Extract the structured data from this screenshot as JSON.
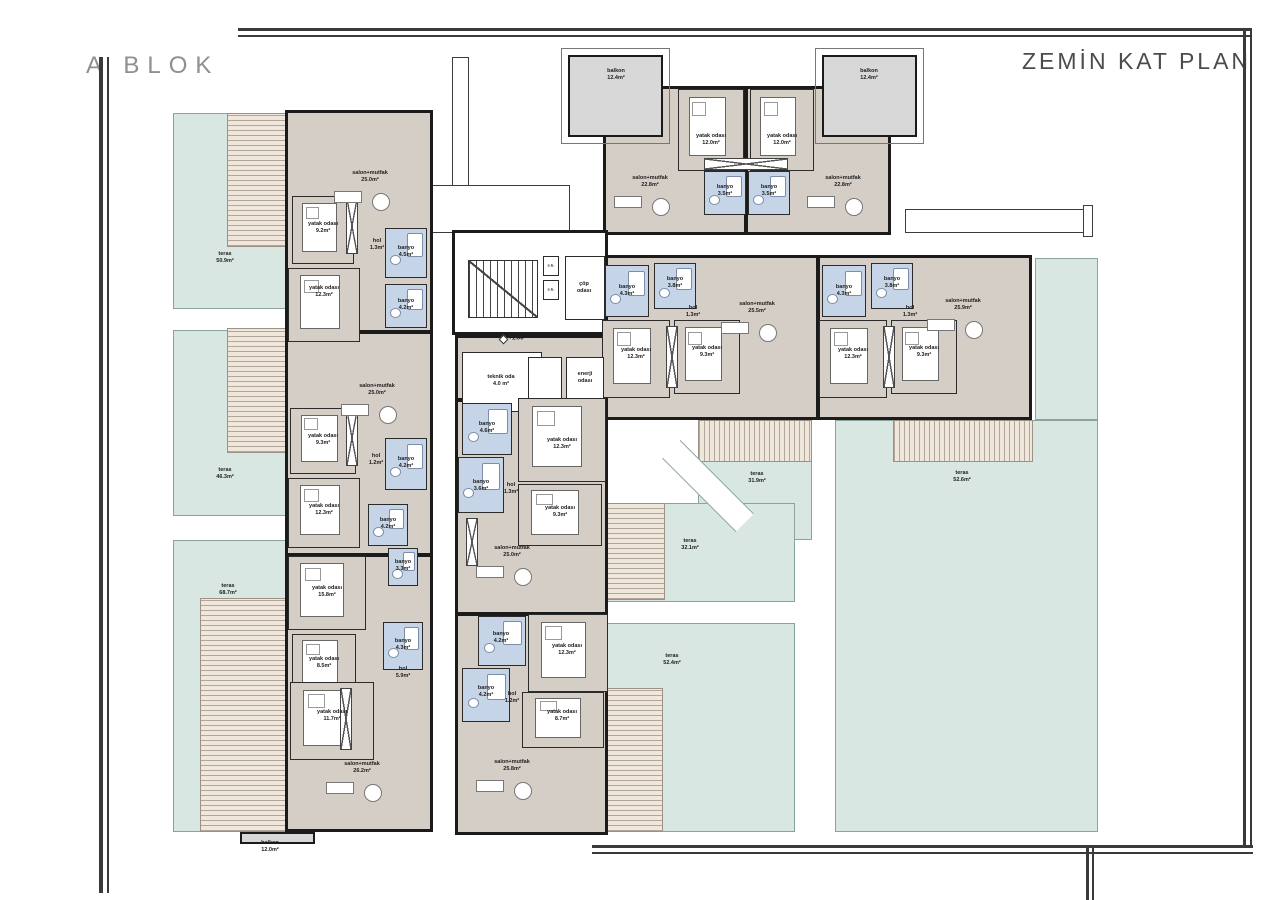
{
  "titles": {
    "block": "A BLOK",
    "plan": "ZEMİN KAT PLAN"
  },
  "colors": {
    "teal": "#d8e7e2",
    "deckA": "#efe7dc",
    "deckLine": "#b3a698",
    "floor": "#d5cec6",
    "bath": "#c5d4e7",
    "wall": "#1b1b1b",
    "balcony": "#d8d8d8",
    "frame": "#3a3a3a",
    "title": "#8f8f8f",
    "plan_title": "#4c4c4c"
  },
  "terraces": [
    {
      "t": "teras",
      "a": "50.9m²",
      "r": [
        173,
        113,
        212,
        196
      ],
      "lx": 225,
      "ly": 258
    },
    {
      "t": "teras",
      "a": "46.3m²",
      "r": [
        173,
        330,
        212,
        186
      ],
      "lx": 225,
      "ly": 474
    },
    {
      "t": "teras",
      "a": "68.7m²",
      "r": [
        173,
        540,
        212,
        292
      ],
      "lx": 228,
      "ly": 590
    },
    {
      "t": "teras",
      "a": "31.9m²",
      "r": [
        698,
        420,
        114,
        120
      ],
      "lx": 757,
      "ly": 478
    },
    {
      "t": "teras",
      "a": "52.6m²",
      "r": [
        1035,
        258,
        63,
        162
      ],
      "lx": null,
      "ly": null
    },
    {
      "t": "teras",
      "a": "52.6m²",
      "r": [
        835,
        420,
        263,
        412
      ],
      "lx": 962,
      "ly": 477
    },
    {
      "t": "teras",
      "a": "32.1m²",
      "r": [
        600,
        503,
        195,
        99
      ],
      "lx": 690,
      "ly": 545
    },
    {
      "t": "teras",
      "a": "52.4m²",
      "r": [
        598,
        623,
        197,
        209
      ],
      "lx": 672,
      "ly": 660
    }
  ],
  "decks": [
    {
      "r": [
        227,
        113,
        63,
        134
      ],
      "v": 0
    },
    {
      "r": [
        227,
        328,
        63,
        125
      ],
      "v": 0
    },
    {
      "r": [
        200,
        598,
        88,
        234
      ],
      "v": 0
    },
    {
      "r": [
        698,
        420,
        114,
        42
      ],
      "v": 1
    },
    {
      "r": [
        893,
        420,
        140,
        42
      ],
      "v": 1
    },
    {
      "r": [
        600,
        503,
        65,
        97
      ],
      "v": 0
    },
    {
      "r": [
        598,
        688,
        65,
        144
      ],
      "v": 0
    }
  ],
  "corridors": [
    [
      452,
      57,
      17,
      176
    ],
    [
      432,
      185,
      138,
      48
    ],
    [
      905,
      209,
      185,
      24
    ],
    [
      1083,
      205,
      10,
      32
    ]
  ],
  "diag": [
    656,
    473,
    104,
    26
  ],
  "buildings": [
    {
      "r": [
        603,
        86,
        288,
        149
      ],
      "f": "beige"
    },
    {
      "r": [
        600,
        255,
        432,
        165
      ],
      "f": "beige"
    },
    {
      "r": [
        285,
        110,
        148,
        722
      ],
      "f": "beige"
    },
    {
      "r": [
        455,
        335,
        153,
        500
      ],
      "f": "beige"
    },
    {
      "r": [
        452,
        230,
        156,
        105
      ],
      "f": "white"
    }
  ],
  "balcony_outlines": [
    [
      561,
      48,
      109,
      96
    ],
    [
      815,
      48,
      109,
      96
    ]
  ],
  "balconies": [
    [
      568,
      55,
      95,
      82
    ],
    [
      822,
      55,
      95,
      82
    ],
    [
      240,
      832,
      75,
      12
    ]
  ],
  "walls": [
    [
      285,
      330,
      148,
      4
    ],
    [
      285,
      553,
      148,
      4
    ],
    [
      455,
      398,
      153,
      4
    ],
    [
      455,
      612,
      153,
      4
    ],
    [
      816,
      255,
      4,
      165
    ],
    [
      744,
      86,
      4,
      149
    ]
  ],
  "rooms": [
    [
      678,
      89,
      66,
      82,
      "b"
    ],
    [
      704,
      171,
      42,
      44,
      "w"
    ],
    [
      748,
      171,
      42,
      44,
      "w"
    ],
    [
      750,
      89,
      64,
      82,
      "b"
    ],
    [
      605,
      265,
      44,
      52,
      "w"
    ],
    [
      654,
      263,
      42,
      46,
      "w"
    ],
    [
      602,
      320,
      68,
      78,
      "b"
    ],
    [
      674,
      320,
      66,
      74,
      "b"
    ],
    [
      822,
      265,
      44,
      52,
      "w"
    ],
    [
      871,
      263,
      42,
      46,
      "w"
    ],
    [
      819,
      320,
      68,
      78,
      "b"
    ],
    [
      891,
      320,
      66,
      74,
      "b"
    ],
    [
      292,
      196,
      62,
      68,
      "b"
    ],
    [
      385,
      228,
      42,
      50,
      "w"
    ],
    [
      385,
      284,
      42,
      44,
      "w"
    ],
    [
      288,
      268,
      72,
      74,
      "b"
    ],
    [
      290,
      408,
      66,
      66,
      "b"
    ],
    [
      385,
      438,
      42,
      52,
      "w"
    ],
    [
      288,
      478,
      72,
      70,
      "b"
    ],
    [
      368,
      504,
      40,
      42,
      "w"
    ],
    [
      288,
      556,
      78,
      74,
      "b"
    ],
    [
      388,
      548,
      30,
      38,
      "w"
    ],
    [
      292,
      634,
      64,
      60,
      "b"
    ],
    [
      383,
      622,
      40,
      48,
      "w"
    ],
    [
      290,
      682,
      84,
      78,
      "b"
    ],
    [
      462,
      352,
      80,
      60,
      "t"
    ],
    [
      528,
      357,
      34,
      42,
      "t"
    ],
    [
      566,
      357,
      38,
      42,
      "t"
    ],
    [
      462,
      403,
      50,
      52,
      "w"
    ],
    [
      518,
      398,
      88,
      84,
      "b"
    ],
    [
      458,
      457,
      46,
      56,
      "w"
    ],
    [
      518,
      484,
      84,
      62,
      "b"
    ],
    [
      478,
      616,
      48,
      50,
      "w"
    ],
    [
      528,
      614,
      80,
      78,
      "b"
    ],
    [
      462,
      668,
      48,
      54,
      "w"
    ],
    [
      522,
      692,
      82,
      56,
      "b"
    ],
    [
      565,
      256,
      40,
      64,
      "t"
    ],
    [
      543,
      256,
      16,
      20,
      "t"
    ],
    [
      543,
      280,
      16,
      20,
      "t"
    ]
  ],
  "closets": [
    [
      704,
      158,
      84,
      12
    ],
    [
      346,
      198,
      12,
      56
    ],
    [
      346,
      410,
      12,
      56
    ],
    [
      340,
      688,
      12,
      62
    ],
    [
      466,
      518,
      12,
      48
    ],
    [
      666,
      326,
      12,
      62
    ],
    [
      883,
      326,
      12,
      62
    ]
  ],
  "stairs": [
    468,
    260,
    70,
    58
  ],
  "level_marker": {
    "r": [
      500,
      336,
      7,
      7
    ],
    "text": "+1.00",
    "x": 516,
    "y": 339
  },
  "labels": [
    {
      "t": "salon+mutfak",
      "a": "22.8m²",
      "x": 650,
      "y": 182,
      "f": 1
    },
    {
      "t": "salon+mutfak",
      "a": "22.8m²",
      "x": 843,
      "y": 182,
      "f": 1
    },
    {
      "t": "yatak odası",
      "a": "12.0m²",
      "x": 711,
      "y": 140
    },
    {
      "t": "yatak odası",
      "a": "12.0m²",
      "x": 782,
      "y": 140
    },
    {
      "t": "banyo",
      "a": "3.5m²",
      "x": 725,
      "y": 191
    },
    {
      "t": "banyo",
      "a": "3.5m²",
      "x": 769,
      "y": 191
    },
    {
      "t": "balkon",
      "a": "12.4m²",
      "x": 616,
      "y": 75
    },
    {
      "t": "balkon",
      "a": "12.4m²",
      "x": 869,
      "y": 75
    },
    {
      "t": "banyo",
      "a": "4.3m²",
      "x": 627,
      "y": 291
    },
    {
      "t": "banyo",
      "a": "3.8m²",
      "x": 675,
      "y": 283
    },
    {
      "t": "hol",
      "a": "1.3m²",
      "x": 693,
      "y": 312
    },
    {
      "t": "yatak odası",
      "a": "12.3m²",
      "x": 636,
      "y": 354
    },
    {
      "t": "yatak odası",
      "a": "9.3m²",
      "x": 707,
      "y": 352
    },
    {
      "t": "salon+mutfak",
      "a": "25.5m²",
      "x": 757,
      "y": 308,
      "f": 1
    },
    {
      "t": "banyo",
      "a": "4.3m²",
      "x": 844,
      "y": 291
    },
    {
      "t": "banyo",
      "a": "3.8m²",
      "x": 892,
      "y": 283
    },
    {
      "t": "hol",
      "a": "1.3m²",
      "x": 910,
      "y": 312
    },
    {
      "t": "yatak odası",
      "a": "12.3m²",
      "x": 853,
      "y": 354
    },
    {
      "t": "yatak odası",
      "a": "9.3m²",
      "x": 924,
      "y": 352
    },
    {
      "t": "salon+mutfak",
      "a": "25.9m²",
      "x": 963,
      "y": 305,
      "f": 1
    },
    {
      "t": "salon+mutfak",
      "a": "25.0m²",
      "x": 370,
      "y": 177,
      "f": 1
    },
    {
      "t": "yatak odası",
      "a": "9.2m²",
      "x": 323,
      "y": 228
    },
    {
      "t": "hol",
      "a": "1.3m²",
      "x": 377,
      "y": 245
    },
    {
      "t": "banyo",
      "a": "4.5m²",
      "x": 406,
      "y": 252
    },
    {
      "t": "banyo",
      "a": "4.2m²",
      "x": 406,
      "y": 305
    },
    {
      "t": "yatak odası",
      "a": "12.3m²",
      "x": 324,
      "y": 292
    },
    {
      "t": "salon+mutfak",
      "a": "25.0m²",
      "x": 377,
      "y": 390,
      "f": 1
    },
    {
      "t": "yatak odası",
      "a": "9.3m²",
      "x": 323,
      "y": 440
    },
    {
      "t": "hol",
      "a": "1.2m²",
      "x": 376,
      "y": 460
    },
    {
      "t": "banyo",
      "a": "4.2m²",
      "x": 406,
      "y": 463
    },
    {
      "t": "yatak odası",
      "a": "12.3m²",
      "x": 324,
      "y": 510
    },
    {
      "t": "banyo",
      "a": "4.2m²",
      "x": 388,
      "y": 524
    },
    {
      "t": "yatak odası",
      "a": "15.8m²",
      "x": 327,
      "y": 592
    },
    {
      "t": "banyo",
      "a": "3.3m²",
      "x": 403,
      "y": 566
    },
    {
      "t": "yatak odası",
      "a": "8.5m²",
      "x": 324,
      "y": 663
    },
    {
      "t": "banyo",
      "a": "4.3m²",
      "x": 403,
      "y": 645
    },
    {
      "t": "hol",
      "a": "5.9m²",
      "x": 403,
      "y": 673
    },
    {
      "t": "yatak odası",
      "a": "11.7m²",
      "x": 332,
      "y": 716
    },
    {
      "t": "salon+mutfak",
      "a": "26.2m²",
      "x": 362,
      "y": 768,
      "f": 1
    },
    {
      "t": "balkon",
      "a": "12.0m²",
      "x": 270,
      "y": 847
    },
    {
      "t": "teknik oda",
      "a": "4.0 m²",
      "x": 501,
      "y": 381
    },
    {
      "t": "enerji\nodası",
      "a": null,
      "x": 585,
      "y": 378
    },
    {
      "t": "banyo",
      "a": "4.6m²",
      "x": 487,
      "y": 428
    },
    {
      "t": "yatak odası",
      "a": "12.3m²",
      "x": 562,
      "y": 444
    },
    {
      "t": "banyo",
      "a": "3.6m²",
      "x": 481,
      "y": 486
    },
    {
      "t": "hol",
      "a": "1.3m²",
      "x": 511,
      "y": 489
    },
    {
      "t": "yatak odası",
      "a": "9.3m²",
      "x": 560,
      "y": 512
    },
    {
      "t": "salon+mutfak",
      "a": "25.0m²",
      "x": 512,
      "y": 552,
      "f": 1
    },
    {
      "t": "banyo",
      "a": "4.2m²",
      "x": 501,
      "y": 638
    },
    {
      "t": "yatak odası",
      "a": "12.3m²",
      "x": 567,
      "y": 650
    },
    {
      "t": "banyo",
      "a": "4.2m²",
      "x": 486,
      "y": 692
    },
    {
      "t": "hol",
      "a": "1.2m²",
      "x": 512,
      "y": 698
    },
    {
      "t": "yatak odası",
      "a": "8.7m²",
      "x": 562,
      "y": 716
    },
    {
      "t": "salon+mutfak",
      "a": "25.8m²",
      "x": 512,
      "y": 766,
      "f": 1
    },
    {
      "t": "çöp\nodası",
      "a": null,
      "x": 584,
      "y": 288
    },
    {
      "t": "s.b.",
      "a": null,
      "x": 551,
      "y": 265,
      "s": 4
    },
    {
      "t": "s.b.",
      "a": null,
      "x": 551,
      "y": 289,
      "s": 4
    }
  ],
  "frame_lines": [
    [
      238,
      28,
      1014,
      3
    ],
    [
      238,
      35,
      1014,
      2
    ],
    [
      1243,
      28,
      3,
      820
    ],
    [
      1250,
      28,
      2,
      820
    ],
    [
      592,
      845,
      661,
      3
    ],
    [
      592,
      852,
      661,
      2
    ],
    [
      99,
      57,
      4,
      836
    ],
    [
      107,
      57,
      2,
      836
    ],
    [
      1086,
      848,
      3,
      52
    ],
    [
      1092,
      848,
      2,
      52
    ]
  ]
}
